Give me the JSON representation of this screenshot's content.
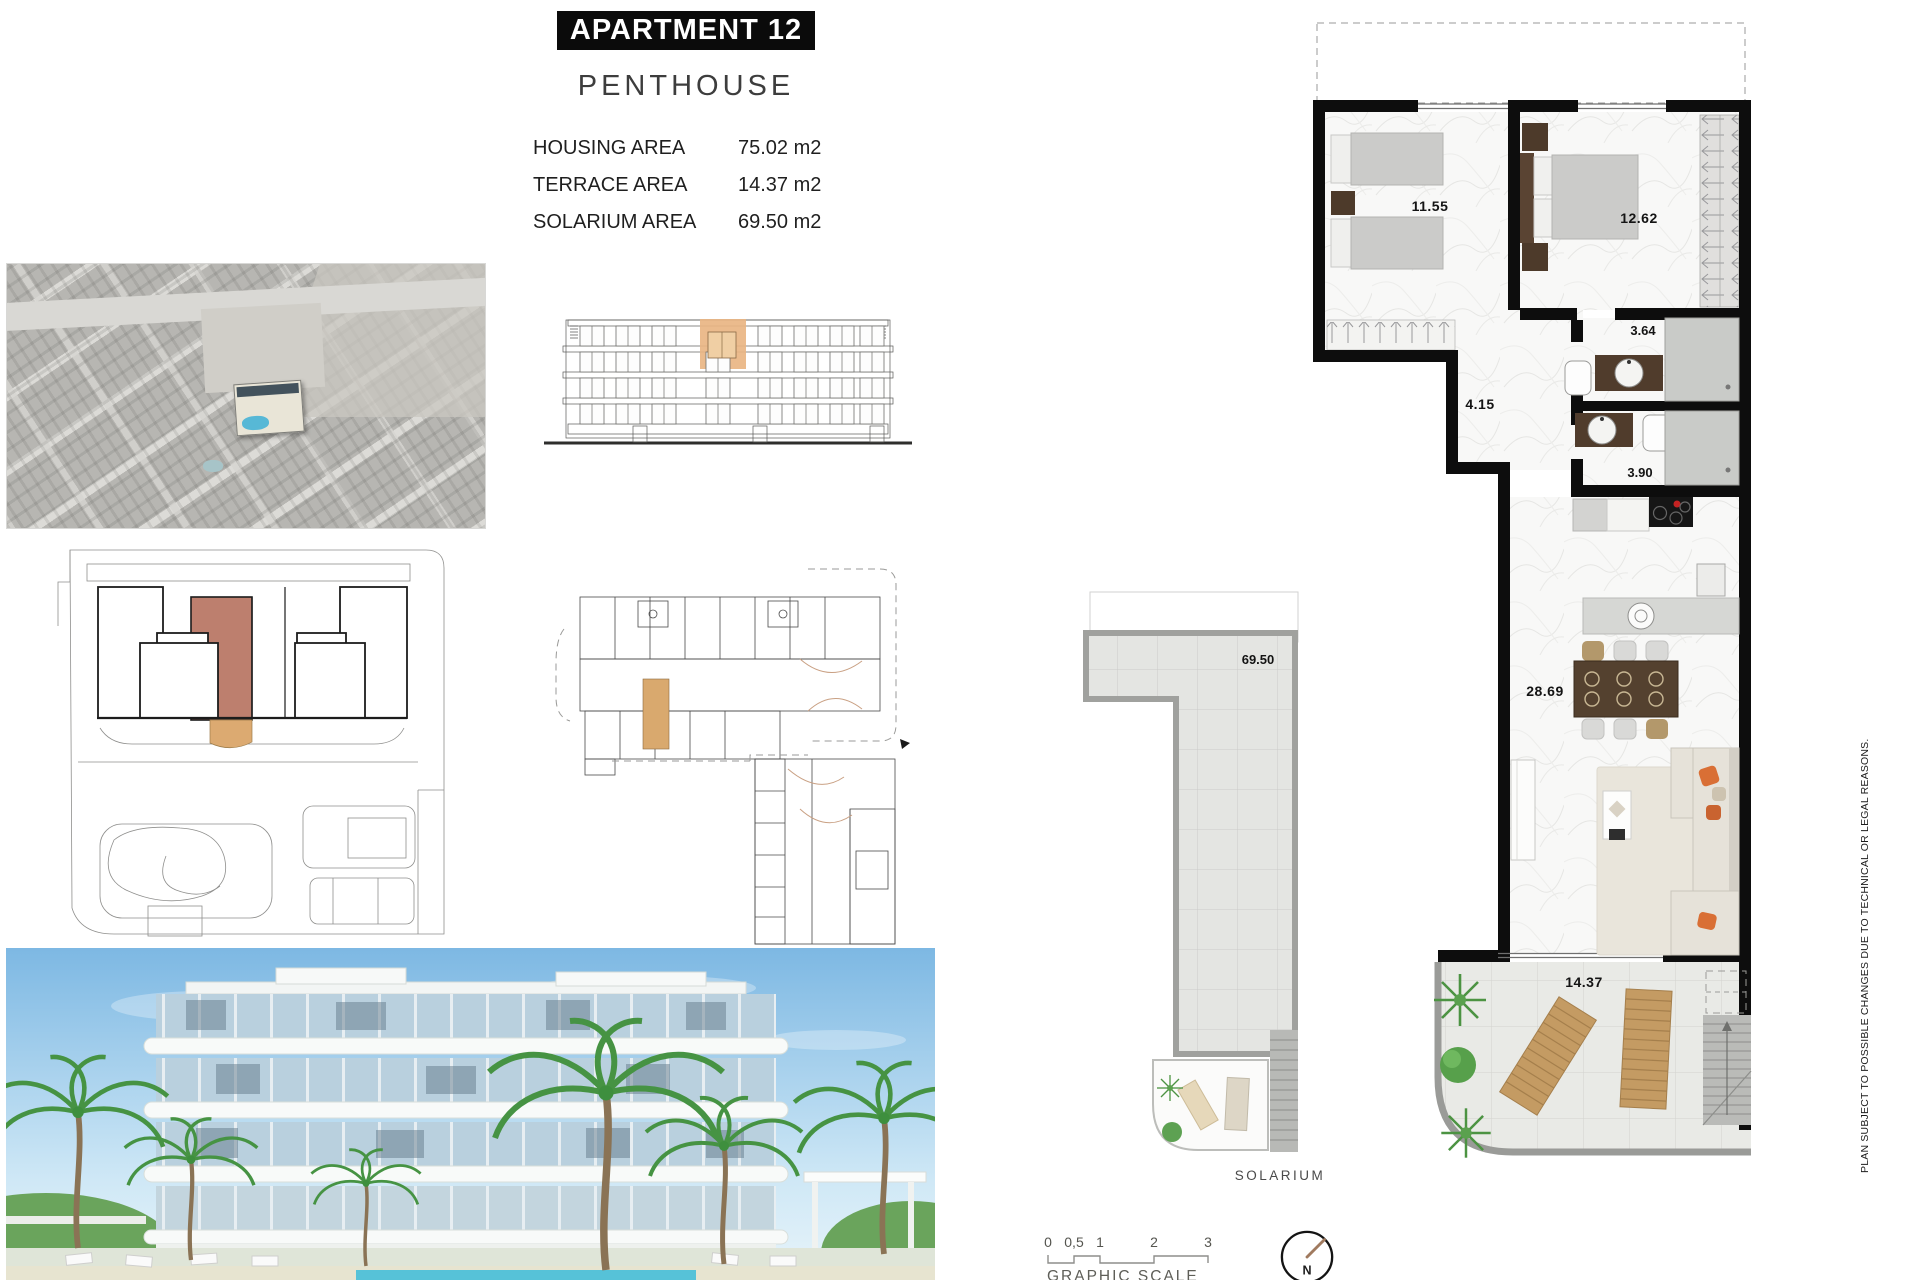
{
  "header": {
    "title": "APARTMENT 12",
    "subtitle": "PENTHOUSE",
    "areas": [
      {
        "label": "HOUSING AREA",
        "value": "75.02 m2"
      },
      {
        "label": "TERRACE AREA",
        "value": "14.37 m2"
      },
      {
        "label": "SOLARIUM AREA",
        "value": "69.50 m2"
      }
    ]
  },
  "floor_plan": {
    "bedroom1_area": "11.55",
    "bedroom2_area": "12.62",
    "bathroom1_area": "3.64",
    "hallway_area": "4.15",
    "bathroom2_area": "3.90",
    "living_area": "28.69",
    "terrace_area": "14.37"
  },
  "solarium": {
    "area": "69.50",
    "label": "SOLARIUM"
  },
  "scale_bar": {
    "ticks": [
      "0",
      "0,5",
      "1",
      "2",
      "3"
    ],
    "label": "GRAPHIC SCALE"
  },
  "compass": {
    "north_label": "N"
  },
  "disclaimer": "PLAN SUBJECT TO POSSIBLE CHANGES DUE TO TECHNICAL OR LEGAL REASONS.",
  "colors": {
    "highlight_unit": "#bd7f6e",
    "highlight_terrace": "#dcaa71",
    "highlight_elevation": "#e9b583",
    "wall": "#0d0d0d",
    "lounger_wood": "#c49b63",
    "pillow_orange": "#d96f35",
    "pool_blue": "#57b8d6"
  }
}
